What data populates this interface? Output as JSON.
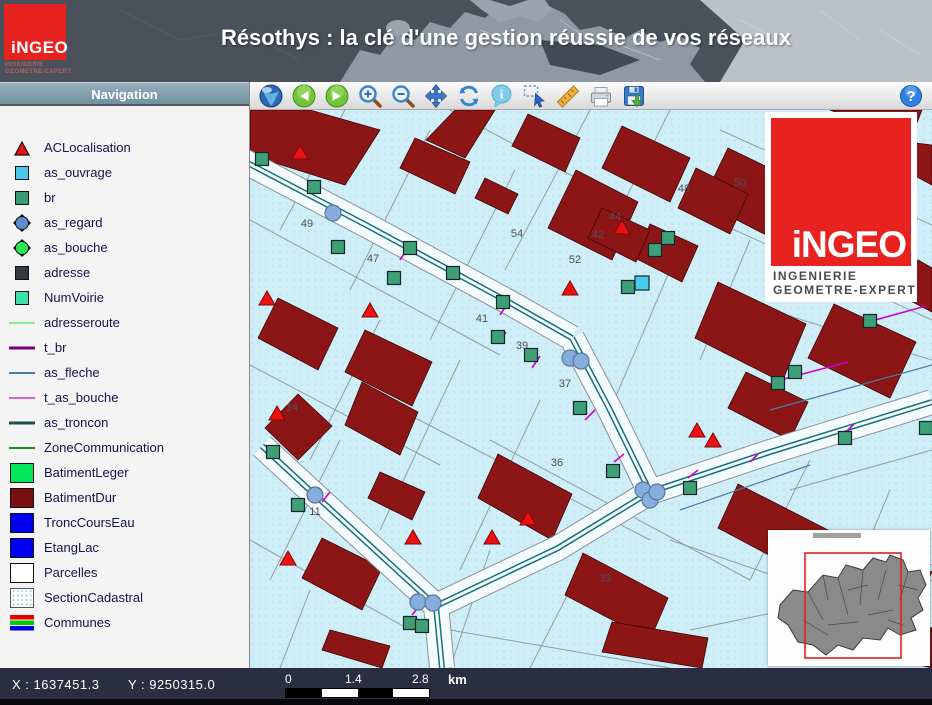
{
  "header": {
    "title": "Résothys : la clé d'une gestion réussie de vos réseaux",
    "logo": {
      "wordmark": "iNGEO",
      "line1": "INGENIERIE",
      "line2": "GEOMETRE-EXPERT"
    }
  },
  "sidebar": {
    "title": "Navigation",
    "layers": [
      {
        "label": "ACLocalisation",
        "swatch": "triangle",
        "color": "#ee1111"
      },
      {
        "label": "as_ouvrage",
        "swatch": "square",
        "color": "#4cc9ea"
      },
      {
        "label": "br",
        "swatch": "square",
        "color": "#3a9a73"
      },
      {
        "label": "as_regard",
        "swatch": "spiked-circle",
        "color": "#5c8fcc"
      },
      {
        "label": "as_bouche",
        "swatch": "spiked-circle",
        "color": "#2ee64f"
      },
      {
        "label": "adresse",
        "swatch": "square",
        "color": "#2f3a3f"
      },
      {
        "label": "NumVoirie",
        "swatch": "square",
        "color": "#3de0a8"
      },
      {
        "label": "adresseroute",
        "swatch": "line",
        "color": "#8ee88e",
        "thickness": 2
      },
      {
        "label": "t_br",
        "swatch": "line",
        "color": "#7a007a",
        "thickness": 3
      },
      {
        "label": "as_fleche",
        "swatch": "line",
        "color": "#4a7aa8",
        "thickness": 2
      },
      {
        "label": "t_as_bouche",
        "swatch": "line",
        "color": "#d966cc",
        "thickness": 2
      },
      {
        "label": "as_troncon",
        "swatch": "line",
        "color": "#1a4f4a",
        "thickness": 3
      },
      {
        "label": "ZoneCommunication",
        "swatch": "line",
        "color": "#1e8c1e",
        "thickness": 2
      },
      {
        "label": "BatimentLeger",
        "swatch": "rect",
        "color": "#00e85a"
      },
      {
        "label": "BatimentDur",
        "swatch": "rect",
        "color": "#7a0f0f"
      },
      {
        "label": "TroncCoursEau",
        "swatch": "rect",
        "color": "#0000ee"
      },
      {
        "label": "EtangLac",
        "swatch": "rect",
        "color": "#0000ee"
      },
      {
        "label": "Parcelles",
        "swatch": "rect",
        "color": "#ffffff"
      },
      {
        "label": "SectionCadastral",
        "swatch": "dotted-rect",
        "color": "#7ad0e0"
      },
      {
        "label": "Communes",
        "swatch": "stripes",
        "colors": [
          "#ee0000",
          "#00cc00",
          "#0000dd"
        ]
      }
    ]
  },
  "toolbar": {
    "buttons": [
      "globe",
      "back",
      "forward",
      "zoom-in",
      "zoom-out",
      "pan",
      "refresh",
      "info",
      "select",
      "measure",
      "print",
      "save"
    ],
    "info_label": "i",
    "help_label": "?"
  },
  "statusbar": {
    "x": "X : 1637451.3",
    "y": "Y : 9250315.0",
    "scale_ticks": [
      "0",
      "1.4",
      "2.8"
    ],
    "unit": "km"
  },
  "map": {
    "colors": {
      "bg": "#cfeef7",
      "dot": "#a8dfec",
      "building": "#8c1616",
      "building_stroke": "#3d0606",
      "road": "#f4fbfe",
      "road_edge": "#8a9096",
      "network": "#17707b",
      "magenta": "#cc00cc",
      "parcel": "#8a9096",
      "label": "#4f4f5a",
      "br_fill": "#3f9f76",
      "regard_fill": "#85aede",
      "regard_stroke": "#5a7696",
      "ouvrage_fill": "#48cdec",
      "triangle_fill": "#ee1111",
      "fleche": "#4a7aa8",
      "point_stroke": "#12262a"
    },
    "roads": [
      "M -12 48 L 118 116 L 255 190 L 322 228",
      "M 322 228 L 360 300 L 400 382",
      "M 400 382 L 520 342 L 682 292",
      "M 400 382 L 308 438 L 186 496",
      "M 12 336 L 66 386 L 186 496",
      "M 186 496 L 192 558"
    ],
    "parcel_lines": [
      [
        0,
        110,
        250,
        245
      ],
      [
        0,
        255,
        190,
        355
      ],
      [
        150,
        300,
        400,
        430
      ],
      [
        240,
        330,
        500,
        470
      ],
      [
        420,
        430,
        682,
        520
      ],
      [
        430,
        95,
        682,
        210
      ],
      [
        470,
        20,
        682,
        115
      ],
      [
        200,
        0,
        330,
        70
      ],
      [
        480,
        390,
        682,
        455
      ],
      [
        520,
        200,
        682,
        250
      ],
      [
        95,
        0,
        30,
        120
      ],
      [
        180,
        20,
        100,
        180
      ],
      [
        265,
        60,
        180,
        230
      ],
      [
        340,
        0,
        255,
        160
      ],
      [
        420,
        0,
        350,
        140
      ],
      [
        130,
        210,
        60,
        350
      ],
      [
        210,
        250,
        130,
        420
      ],
      [
        90,
        330,
        20,
        470
      ],
      [
        290,
        290,
        210,
        460
      ],
      [
        420,
        160,
        360,
        300
      ],
      [
        500,
        130,
        450,
        250
      ],
      [
        560,
        350,
        500,
        470
      ],
      [
        640,
        380,
        590,
        500
      ],
      [
        240,
        440,
        200,
        558
      ],
      [
        320,
        480,
        280,
        558
      ],
      [
        610,
        60,
        560,
        170
      ],
      [
        60,
        480,
        30,
        558
      ],
      [
        0,
        430,
        160,
        520
      ],
      [
        200,
        520,
        420,
        558
      ],
      [
        440,
        520,
        682,
        470
      ],
      [
        540,
        380,
        682,
        340
      ]
    ],
    "buildings": [
      "0,0 0,45 95,75 130,20 60,0",
      "150,58 205,84 220,52 165,28",
      "225,88 258,104 268,84 235,68",
      "176,30 215,48 245,0 205,0",
      "262,36 315,62 330,28 278,4",
      "298,118 362,150 388,92 326,60",
      "385,148 432,172 448,136 400,114",
      "452,92 522,128 548,72 478,38",
      "560,118 622,150 642,102 582,72",
      "645,55 682,75 682,35 658,32",
      "8,228 68,260 88,218 28,188",
      "95,262 162,296 182,252 115,220",
      "95,315 150,345 168,302 112,272",
      "118,388 162,410 175,382 130,362",
      "15,318 48,350 82,316 48,284",
      "52,468 112,500 132,458 72,428",
      "72,540 132,558 140,536 80,520",
      "228,388 302,430 322,384 248,344",
      "315,485 400,530 418,488 333,443",
      "352,542 452,558 458,528 362,512",
      "468,418 562,468 582,422 488,374",
      "588,468 662,504 682,462 608,426",
      "598,538 682,558 682,518 614,502",
      "445,228 532,272 556,214 468,172",
      "558,248 640,288 666,232 584,194",
      "655,188 682,202 682,158 668,150",
      "478,298 540,330 558,292 496,262",
      "352,58 420,92 440,48 372,16",
      "428,98 480,124 498,84 446,58",
      "338,128 386,152 400,120 352,98",
      "580,0 660,30 672,0"
    ],
    "magenta_ticks": [
      [
        150,
        150,
        158,
        138
      ],
      [
        250,
        205,
        258,
        193
      ],
      [
        282,
        258,
        290,
        246
      ],
      [
        335,
        310,
        345,
        300
      ],
      [
        364,
        352,
        374,
        344
      ],
      [
        438,
        368,
        448,
        360
      ],
      [
        500,
        352,
        508,
        344
      ],
      [
        596,
        322,
        604,
        314
      ],
      [
        72,
        392,
        80,
        382
      ],
      [
        162,
        505,
        170,
        495
      ],
      [
        530,
        270,
        598,
        252
      ],
      [
        618,
        212,
        676,
        196
      ],
      [
        250,
        232,
        256,
        222
      ]
    ],
    "fleche_lines": [
      [
        520,
        300,
        682,
        255
      ],
      [
        430,
        400,
        560,
        355
      ]
    ],
    "green_squares": [
      [
        12,
        49
      ],
      [
        64,
        77
      ],
      [
        88,
        137
      ],
      [
        160,
        138
      ],
      [
        144,
        168
      ],
      [
        203,
        163
      ],
      [
        253,
        192
      ],
      [
        248,
        227
      ],
      [
        281,
        245
      ],
      [
        330,
        298
      ],
      [
        363,
        361
      ],
      [
        440,
        378
      ],
      [
        418,
        128
      ],
      [
        405,
        140
      ],
      [
        378,
        177
      ],
      [
        620,
        211
      ],
      [
        545,
        262
      ],
      [
        528,
        273
      ],
      [
        595,
        328
      ],
      [
        23,
        342
      ],
      [
        48,
        395
      ],
      [
        160,
        513
      ],
      [
        172,
        516
      ],
      [
        676,
        318
      ]
    ],
    "cyan_squares": [
      [
        392,
        173
      ]
    ],
    "blue_circles": [
      [
        83,
        103
      ],
      [
        320,
        248
      ],
      [
        331,
        251
      ],
      [
        393,
        380
      ],
      [
        400,
        390
      ],
      [
        407,
        382
      ],
      [
        168,
        492
      ],
      [
        183,
        493
      ],
      [
        65,
        385
      ]
    ],
    "triangles": [
      [
        50,
        42
      ],
      [
        17,
        188
      ],
      [
        120,
        200
      ],
      [
        320,
        178
      ],
      [
        372,
        117
      ],
      [
        27,
        303
      ],
      [
        38,
        448
      ],
      [
        163,
        427
      ],
      [
        242,
        427
      ],
      [
        278,
        408
      ],
      [
        447,
        320
      ],
      [
        463,
        330
      ]
    ],
    "labels": [
      {
        "t": "49",
        "x": 57,
        "y": 117
      },
      {
        "t": "47",
        "x": 123,
        "y": 152
      },
      {
        "t": "41",
        "x": 232,
        "y": 212
      },
      {
        "t": "54",
        "x": 267,
        "y": 127
      },
      {
        "t": "52",
        "x": 325,
        "y": 153
      },
      {
        "t": "44",
        "x": 365,
        "y": 110
      },
      {
        "t": "42",
        "x": 348,
        "y": 128
      },
      {
        "t": "48",
        "x": 434,
        "y": 82
      },
      {
        "t": "50",
        "x": 490,
        "y": 76
      },
      {
        "t": "39",
        "x": 272,
        "y": 239
      },
      {
        "t": "37",
        "x": 315,
        "y": 277
      },
      {
        "t": "36",
        "x": 307,
        "y": 356
      },
      {
        "t": "33",
        "x": 355,
        "y": 472
      },
      {
        "t": "14",
        "x": 42,
        "y": 301
      },
      {
        "t": "11",
        "x": 65,
        "y": 405
      }
    ]
  },
  "overview": {
    "blob": "12,75 25,60 40,62 55,45 70,48 78,35 95,40 105,28 118,32 122,25 135,30 140,42 152,40 158,55 150,68 155,80 143,88 148,100 132,105 120,98 112,110 95,108 85,120 70,115 58,125 45,115 30,112 20,95 10,88",
    "lines": [
      [
        40,
        62,
        55,
        90
      ],
      [
        70,
        48,
        80,
        85
      ],
      [
        95,
        40,
        92,
        75
      ],
      [
        118,
        40,
        110,
        70
      ],
      [
        60,
        95,
        90,
        92
      ],
      [
        100,
        85,
        125,
        80
      ],
      [
        35,
        90,
        60,
        105
      ],
      [
        130,
        55,
        150,
        60
      ],
      [
        80,
        60,
        100,
        55
      ],
      [
        120,
        90,
        135,
        95
      ],
      [
        55,
        45,
        60,
        70
      ],
      [
        140,
        42,
        132,
        70
      ]
    ],
    "extent": [
      37,
      23,
      96,
      105
    ],
    "thumb": [
      45,
      3,
      48,
      5
    ]
  }
}
